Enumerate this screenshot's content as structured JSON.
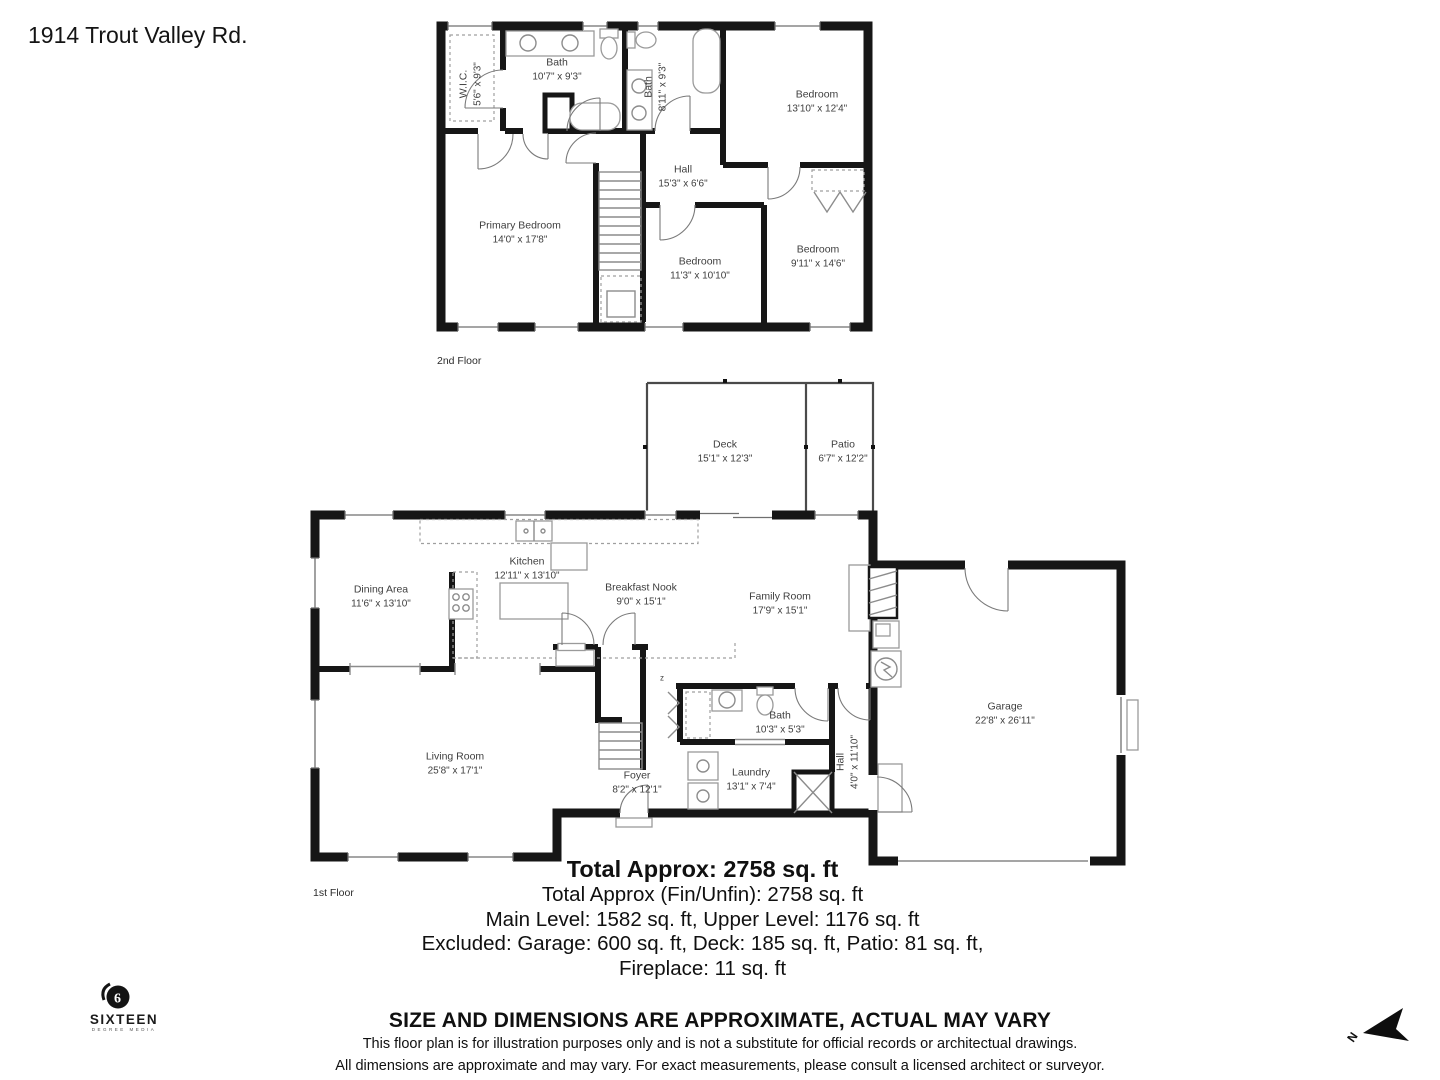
{
  "title": "1914 Trout Valley Rd.",
  "second_floor": {
    "floor_label": "2nd Floor",
    "rooms": {
      "wic": {
        "name": "W.I.C.",
        "dims": "5'6\" x 9'3\""
      },
      "bath1": {
        "name": "Bath",
        "dims": "10'7\" x 9'3\""
      },
      "bath2": {
        "name": "Bath",
        "dims": "8'11\" x 9'3\""
      },
      "bedroom_tr": {
        "name": "Bedroom",
        "dims": "13'10\" x 12'4\""
      },
      "hall": {
        "name": "Hall",
        "dims": "15'3\" x 6'6\""
      },
      "primary": {
        "name": "Primary Bedroom",
        "dims": "14'0\" x 17'8\""
      },
      "bedroom_c": {
        "name": "Bedroom",
        "dims": "11'3\" x 10'10\""
      },
      "bedroom_br": {
        "name": "Bedroom",
        "dims": "9'11\" x 14'6\""
      }
    }
  },
  "first_floor": {
    "floor_label": "1st Floor",
    "switch_symbol": "z",
    "rooms": {
      "deck": {
        "name": "Deck",
        "dims": "15'1\" x 12'3\""
      },
      "patio": {
        "name": "Patio",
        "dims": "6'7\" x 12'2\""
      },
      "dining": {
        "name": "Dining Area",
        "dims": "11'6\" x 13'10\""
      },
      "kitchen": {
        "name": "Kitchen",
        "dims": "12'11\" x 13'10\""
      },
      "nook": {
        "name": "Breakfast Nook",
        "dims": "9'0\" x 15'1\""
      },
      "family": {
        "name": "Family Room",
        "dims": "17'9\" x 15'1\""
      },
      "living": {
        "name": "Living Room",
        "dims": "25'8\" x 17'1\""
      },
      "foyer": {
        "name": "Foyer",
        "dims": "8'2\" x 12'1\""
      },
      "bath": {
        "name": "Bath",
        "dims": "10'3\" x 5'3\""
      },
      "laundry": {
        "name": "Laundry",
        "dims": "13'1\" x 7'4\""
      },
      "hall": {
        "name": "Hall",
        "dims": "4'0\" x 11'10\""
      },
      "garage": {
        "name": "Garage",
        "dims": "22'8\" x 26'11\""
      }
    }
  },
  "summary": {
    "line1": "Total Approx: 2758 sq. ft",
    "line2": "Total Approx (Fin/Unfin): 2758 sq. ft",
    "line3": "Main Level: 1582 sq. ft, Upper Level: 1176 sq. ft",
    "line4": "Excluded: Garage: 600 sq. ft, Deck: 185 sq. ft, Patio: 81 sq. ft,",
    "line5": "Fireplace: 11 sq. ft"
  },
  "disclaimer": {
    "headline": "SIZE AND DIMENSIONS ARE APPROXIMATE, ACTUAL MAY VARY",
    "line1": "This floor plan is for illustration purposes only and is not a substitute for official records or architectual drawings.",
    "line2": "All dimensions are approximate and may vary. For exact measurements, please consult a licensed architect or surveyor."
  },
  "logo": {
    "number": "6",
    "name": "SIXTEEN",
    "tagline": "DEGREE MEDIA"
  },
  "compass": {
    "label": "N"
  },
  "colors": {
    "wall": "#161616",
    "fixture": "#8c8c8c",
    "label": "#3e3e3e"
  }
}
